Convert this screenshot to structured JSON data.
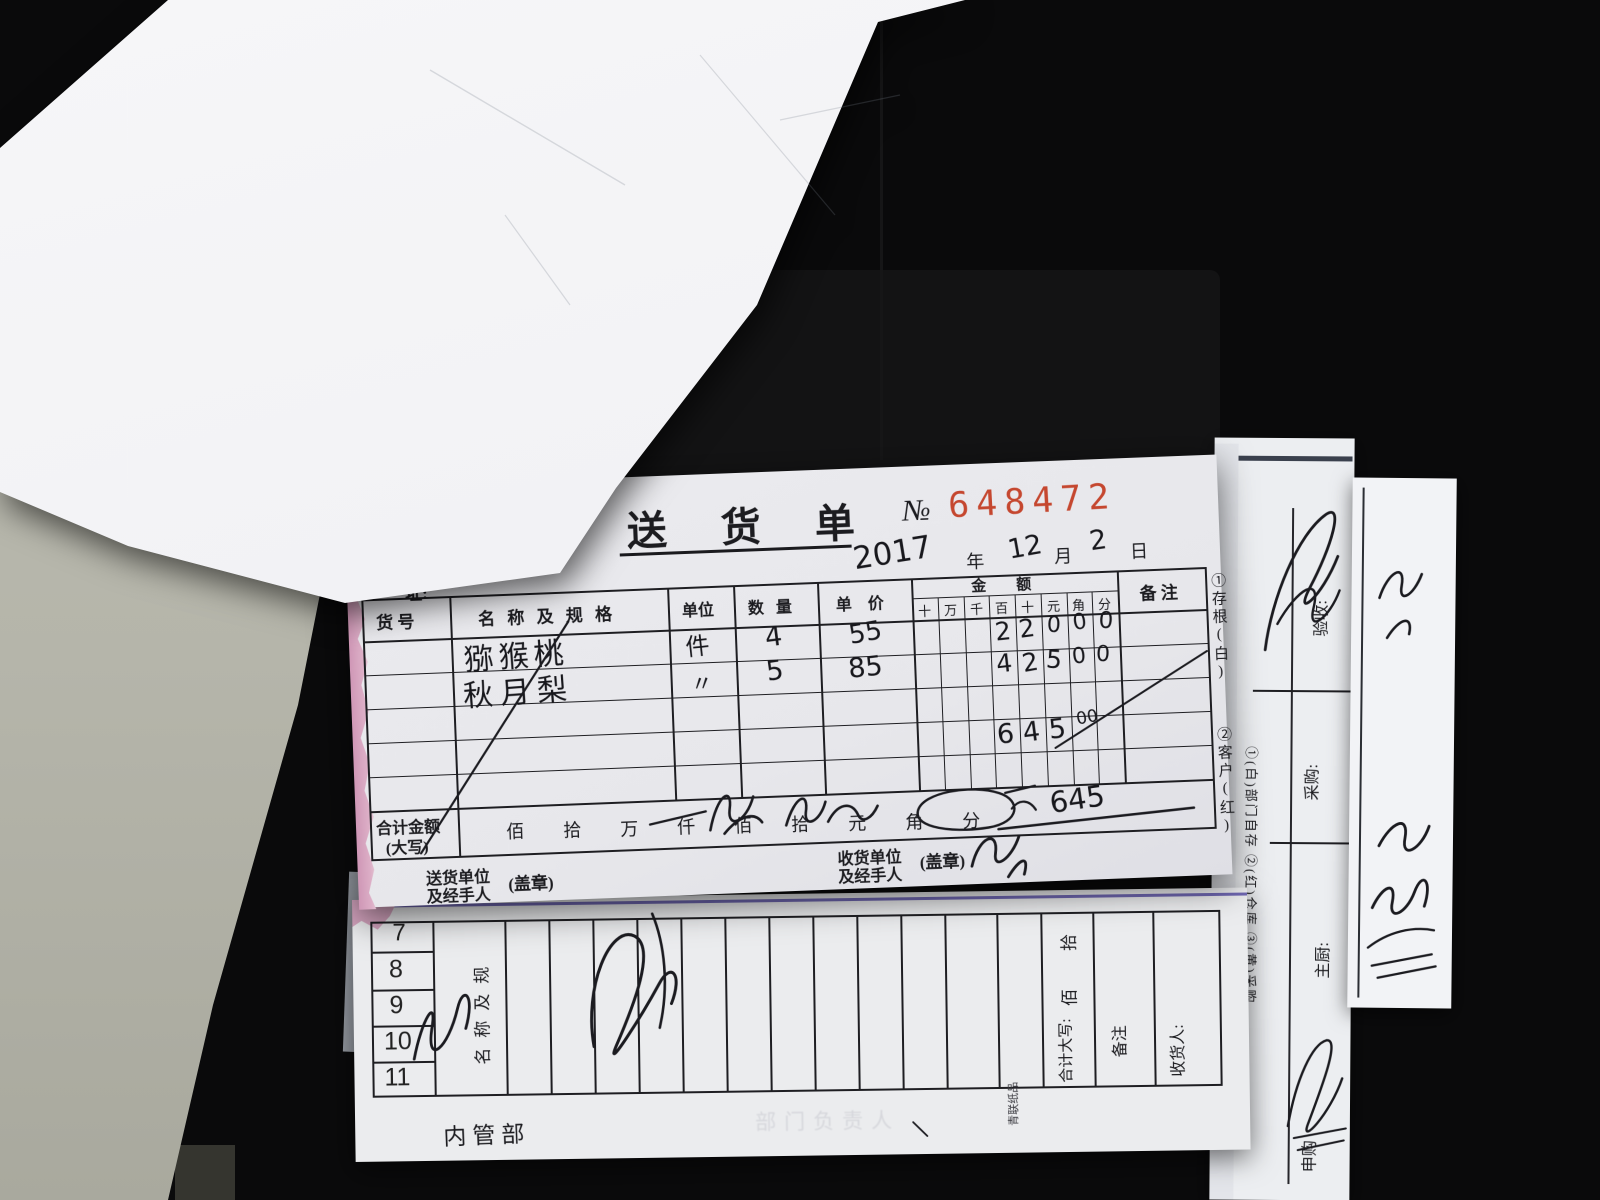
{
  "colors": {
    "red_number": "#c5472f",
    "pink_edge": "#d9a9c2",
    "purple_line": "#5b51a8",
    "wall": "#b9b9ae"
  },
  "delivery_note": {
    "title": "送 货 单",
    "no_label": "№",
    "no_value": "648472",
    "date": {
      "year": "2017",
      "year_suffix": "年",
      "month": "12",
      "month_suffix": "月",
      "day": "2",
      "day_suffix": "日"
    },
    "address_partial": "址:",
    "table": {
      "headers": {
        "item_no": "货 号",
        "name_spec": "名 称 及 规 格",
        "unit": "单位",
        "qty": "数 量",
        "price": "单 价",
        "amount": "金　　额",
        "digits": [
          "十",
          "万",
          "千",
          "百",
          "十",
          "元",
          "角",
          "分"
        ],
        "remark": "备 注"
      },
      "rows": [
        {
          "name": "猕猴桃",
          "unit": "件",
          "qty": "4",
          "price": "55",
          "digits": [
            "2",
            "2",
            "0",
            "0",
            "0"
          ]
        },
        {
          "name": "秋月梨",
          "unit": "〃",
          "qty": "5",
          "price": "85",
          "digits": [
            "4",
            "2",
            "5",
            "0",
            "0"
          ]
        }
      ],
      "total": {
        "digits": [
          "6",
          "4",
          "5"
        ],
        "cents": "00"
      },
      "sum_label_1": "合计金额",
      "sum_label_2": "(大写)",
      "sum_units": [
        "佰",
        "拾",
        "万",
        "仟",
        "佰",
        "拾",
        "元",
        "角",
        "分"
      ],
      "sum_handwritten": "645"
    },
    "footer": {
      "sender_line1": "送货单位",
      "sender_line2": "及经手人",
      "stamp": "(盖章)",
      "receiver_line1": "收货单位",
      "receiver_line2": "及经手人"
    },
    "copies": {
      "copy1": "①存根(白)",
      "copy2": "②客户(红)"
    }
  },
  "bottom_form": {
    "numbers": [
      "7",
      "8",
      "9",
      "10",
      "11"
    ],
    "header_vertical": "名称及规",
    "units": [
      "拾",
      "佰"
    ],
    "sum_label": "合计大写:",
    "remark_label": "备注",
    "receiver_label": "收货人:",
    "brand": "青联纸品",
    "bottom_left": "内管部",
    "ghost_text": "部门负责人"
  },
  "side_papers": {
    "caption": "①(白)部门自存 ②(红)仓库 ③(黄)采购",
    "check_label": "验收:",
    "purchase_label": "采购:",
    "chef_label": "主厨:",
    "requisition_label": "申购"
  }
}
